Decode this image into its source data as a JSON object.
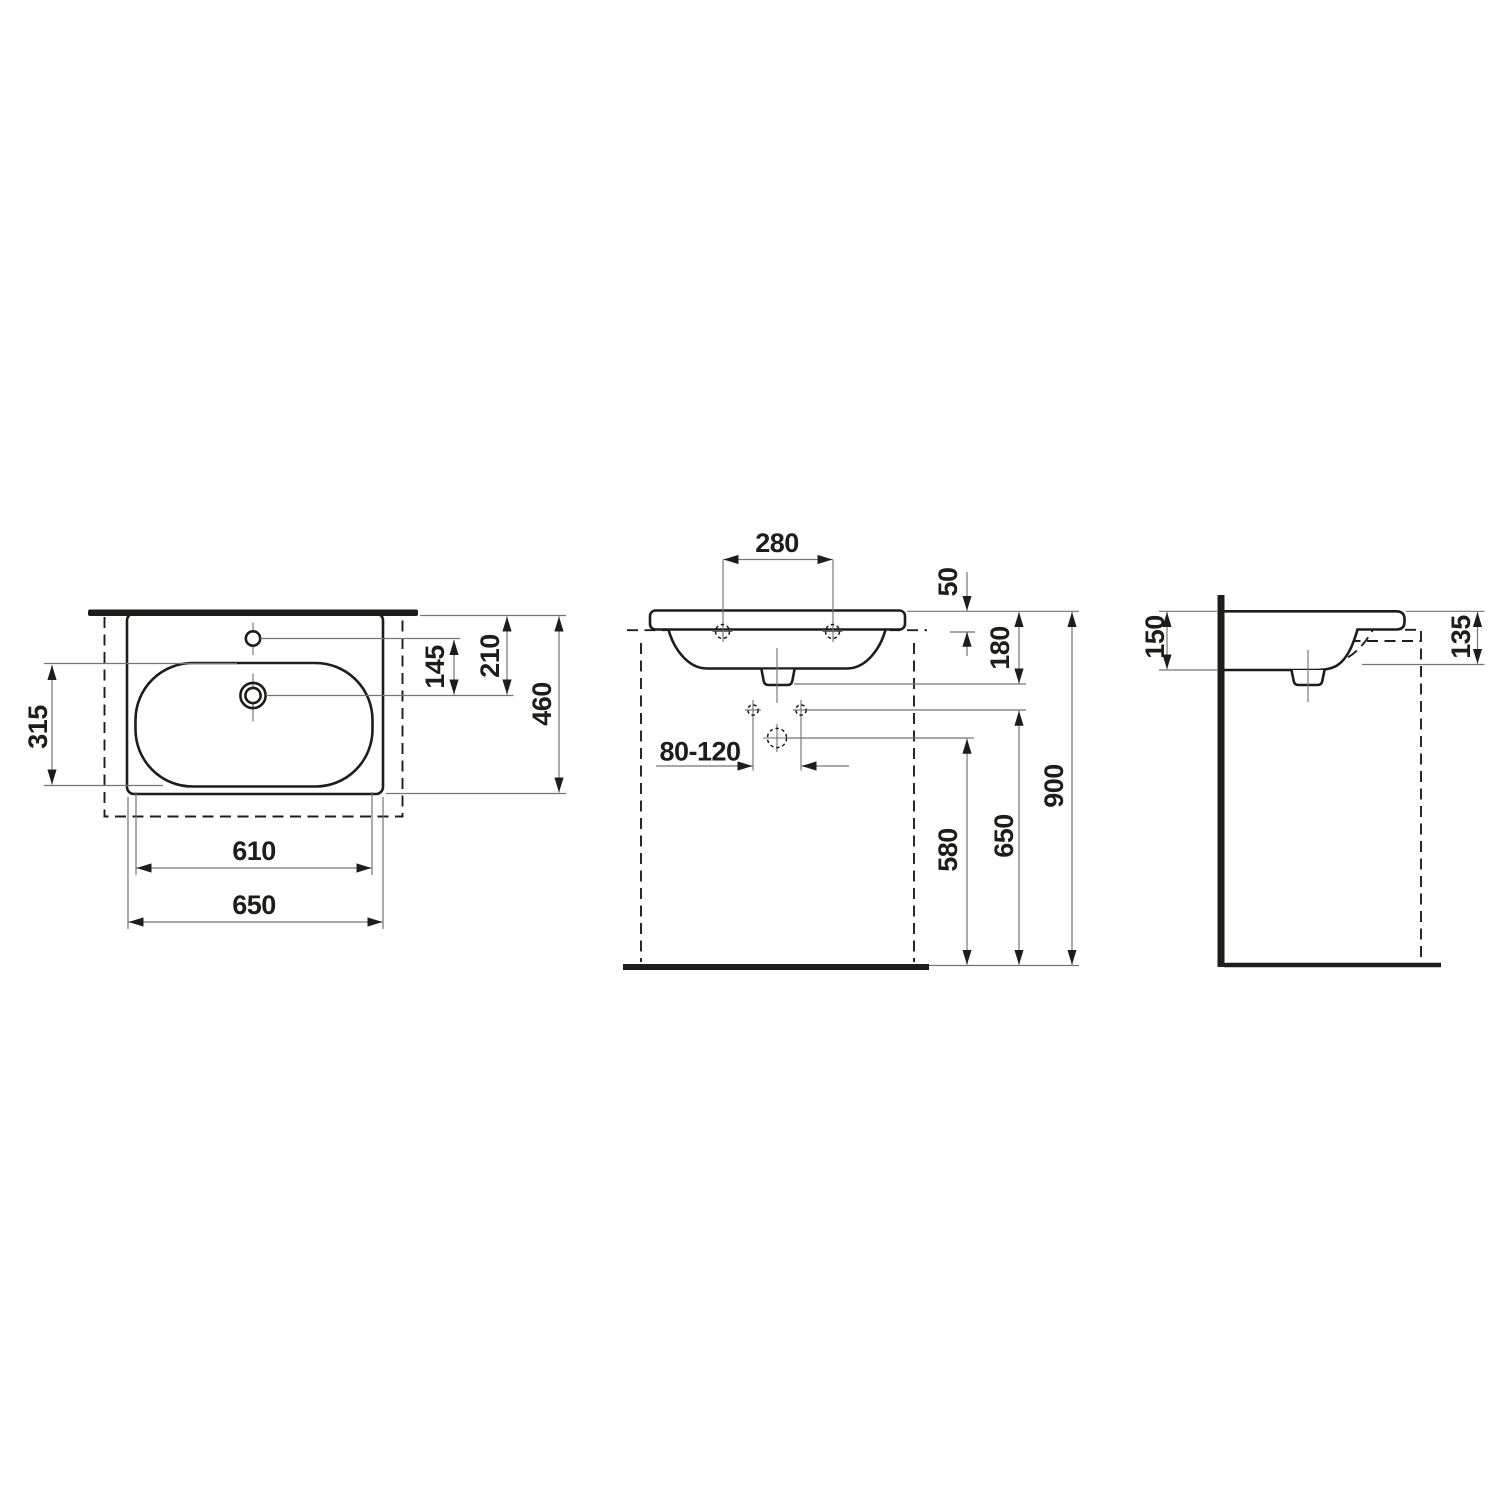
{
  "drawing": {
    "kind": "washbasin dimensional drawing",
    "colors": {
      "object_line": "#1d1d1b",
      "dimension_line": "#757575",
      "background": "#ffffff"
    },
    "views": {
      "top": {
        "label": "plan view",
        "dims": {
          "bowl_depth": "315",
          "taphole_to_drain": "145",
          "edge_to_drain": "210",
          "overall_depth": "460",
          "bowl_width": "610",
          "overall_width": "650"
        }
      },
      "front": {
        "label": "front view",
        "dims": {
          "taphole_spacing": "280",
          "rim_to_fixing": "50",
          "rim_to_outlet": "180",
          "drain_offset_range": "80-120",
          "trap_height": "580",
          "fixing_height": "650",
          "rim_height": "900"
        }
      },
      "side": {
        "label": "side view",
        "dims": {
          "wall_depth": "150",
          "front_depth": "135"
        }
      }
    }
  }
}
